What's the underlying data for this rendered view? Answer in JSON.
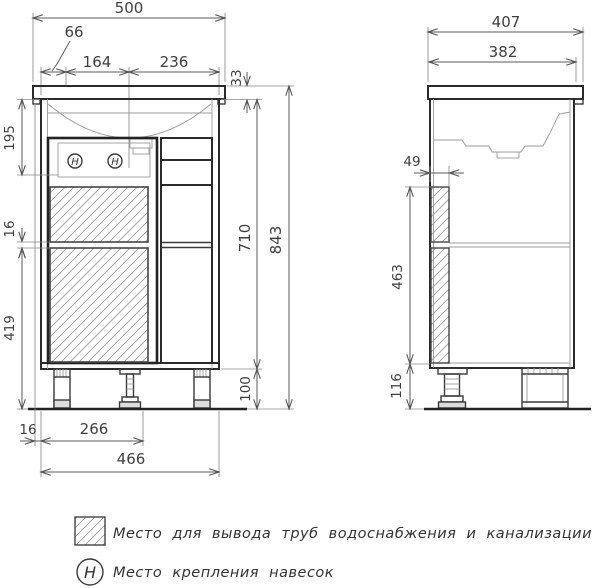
{
  "colors": {
    "line": "#2b2b2b",
    "background": "#ffffff"
  },
  "front_view": {
    "dims": {
      "total_width": "500",
      "left_offset": "66",
      "ref_left": "164",
      "ref_right": "236",
      "countertop_thickness": "33",
      "hinge_zone_height": "195",
      "shelf_gap": "16",
      "lower_section_height": "419",
      "body_height": "710",
      "total_height": "843",
      "leg_height": "100",
      "base_offset": "16",
      "leg_span": "266",
      "body_width": "466"
    },
    "hinge_letter": "H"
  },
  "side_view": {
    "dims": {
      "total_depth": "407",
      "body_depth": "382",
      "pipe_strip_width": "49",
      "pipe_strip_height": "463",
      "leg_height": "116"
    }
  },
  "legend": {
    "items": [
      {
        "symbol": "hatch-square",
        "label": "Место для вывода труб водоснабжения и канализации"
      },
      {
        "symbol": "hinge-circle",
        "symbol_letter": "H",
        "label": "Место крепления навесок"
      }
    ]
  }
}
